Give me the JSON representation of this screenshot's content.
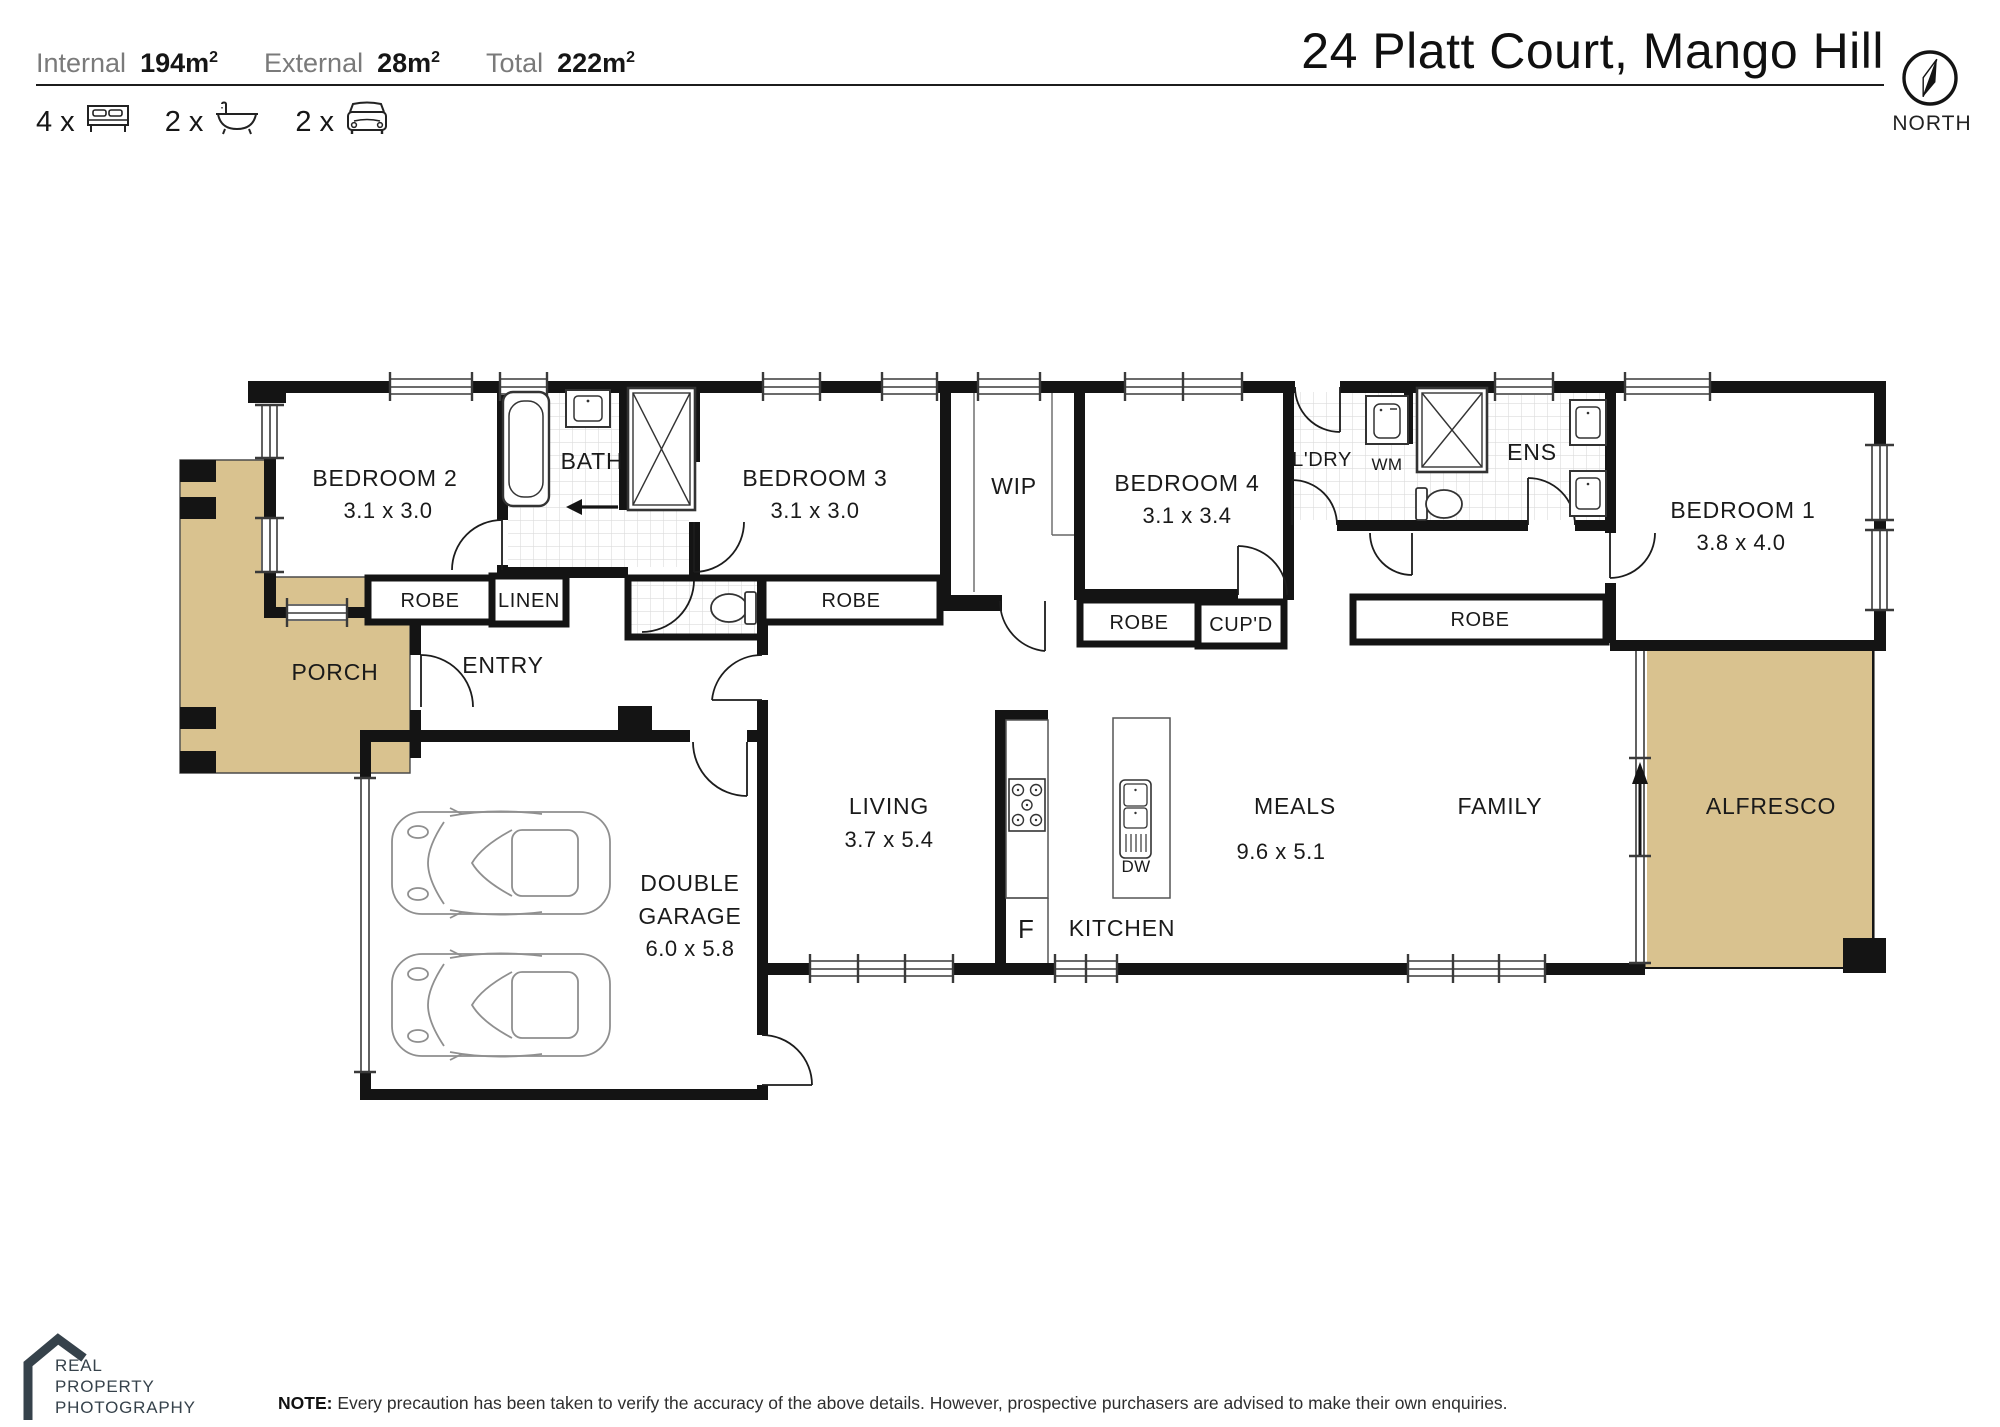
{
  "header": {
    "stats": [
      {
        "label": "Internal",
        "value": "194m",
        "sup": "2"
      },
      {
        "label": "External",
        "value": "28m",
        "sup": "2"
      },
      {
        "label": "Total",
        "value": "222m",
        "sup": "2"
      }
    ],
    "features": [
      {
        "count": "4 x",
        "icon": "bed-icon"
      },
      {
        "count": "2 x",
        "icon": "bath-icon"
      },
      {
        "count": "2 x",
        "icon": "car-icon"
      }
    ],
    "title": "24 Platt Court, Mango Hill",
    "compass": {
      "label": "NORTH"
    }
  },
  "plan": {
    "rooms": {
      "bedroom2": {
        "name": "BEDROOM 2",
        "dims": "3.1 x 3.0"
      },
      "bath": {
        "name": "BATH"
      },
      "bedroom3": {
        "name": "BEDROOM 3",
        "dims": "3.1 x 3.0"
      },
      "wip": {
        "name": "WIP"
      },
      "bedroom4": {
        "name": "BEDROOM 4",
        "dims": "3.1 x 3.4"
      },
      "laundry": {
        "name": "L'DRY"
      },
      "ens": {
        "name": "ENS"
      },
      "bedroom1": {
        "name": "BEDROOM 1",
        "dims": "3.8 x 4.0"
      },
      "porch": {
        "name": "PORCH"
      },
      "entry": {
        "name": "ENTRY"
      },
      "garage": {
        "lines": [
          "DOUBLE",
          "GARAGE"
        ],
        "dims": "6.0 x 5.8"
      },
      "living": {
        "name": "LIVING",
        "dims": "3.7 x 5.4"
      },
      "kitchen": {
        "name": "KITCHEN"
      },
      "meals": {
        "name": "MEALS",
        "dims": "9.6 x 5.1"
      },
      "family": {
        "name": "FAMILY"
      },
      "alfresco": {
        "name": "ALFRESCO"
      }
    },
    "storage": {
      "robe": "ROBE",
      "linen": "LINEN",
      "cupd": "CUP'D"
    },
    "appliances": {
      "wm": "WM",
      "dw": "DW",
      "fridge": "F"
    }
  },
  "footer": {
    "logo_lines": [
      "REAL",
      "PROPERTY",
      "PHOTOGRAPHY"
    ],
    "note_label": "NOTE:",
    "note_text": " Every precaution has been taken to verify the accuracy of the above details. However, prospective purchasers are advised to make their own enquiries."
  },
  "colors": {
    "outdoor_fill": "#D9C28F",
    "wall": "#141414",
    "logo": "#36424B"
  }
}
